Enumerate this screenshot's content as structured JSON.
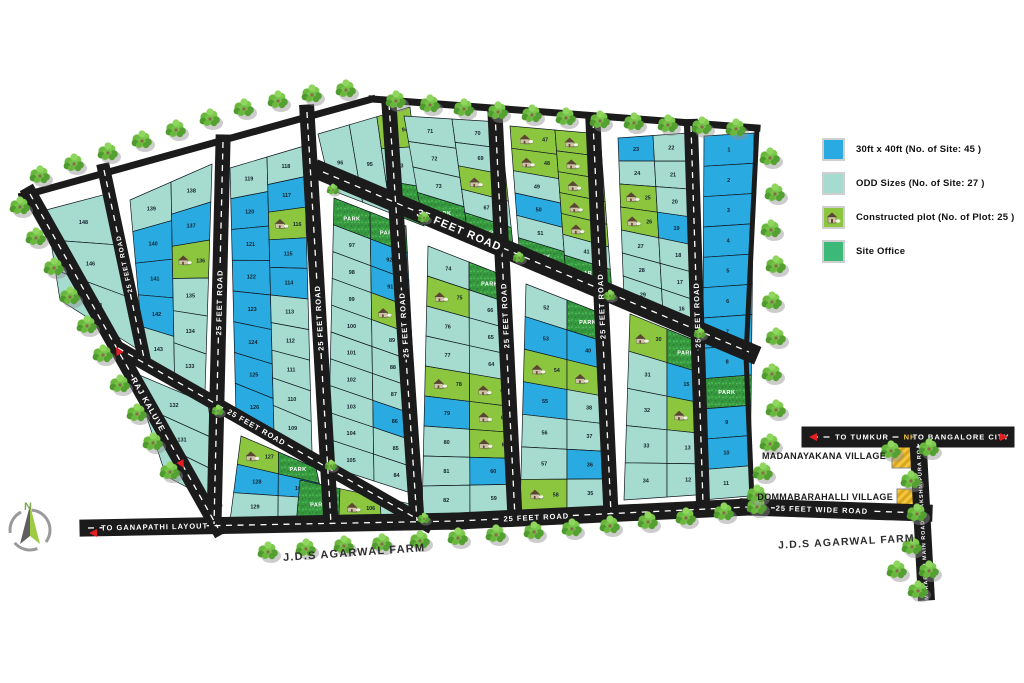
{
  "legend": {
    "items": [
      {
        "key": "blue",
        "label": "30ft x 40ft (No. of Site: 45 )"
      },
      {
        "key": "odd",
        "label": "ODD Sizes (No. of Site: 27 )"
      },
      {
        "key": "constructed",
        "label": "Constructed plot (No. of Plot: 25 )"
      },
      {
        "key": "office",
        "label": "Site Office"
      }
    ]
  },
  "colors": {
    "blue": "#29ABE2",
    "odd": "#A5DCCF",
    "constructed": "#8CC63F",
    "office": "#3CB878",
    "road": "#1b1b1b",
    "park_base": "#37993F",
    "number": "#15222e",
    "arrow_red": "#E31E24",
    "village_yellow": "#F4C73C",
    "nh_yellow": "#F4C73C"
  },
  "roads": {
    "raj_kaluve": "RAJ KALUVE",
    "feet25": "25 FEET ROAD",
    "feet35": "35 FEET ROAD",
    "feet25wide": "25 FEET WIDE ROAD",
    "to_ganapathi": "TO GANAPATHI LAYOUT",
    "to_tumkur": "TO TUMKUR",
    "nh": "NH",
    "to_bangalore": "TO BANGALORE CITY",
    "main_road": "MARABADI MAIN ROAD - LAKSHMIPURA ROAD"
  },
  "places": {
    "village1": "MADANAYAKANA VILLAGE",
    "village2": "DOMMABARAHALLI VILLAGE",
    "farm": "J.D.S AGARWAL FARM",
    "park": "PARK",
    "compass_n": "N"
  },
  "plots": {
    "A": [
      [
        "148:o",
        "146:o",
        "144:o"
      ]
    ],
    "B": [
      [
        "139:o",
        "140:b",
        "141:b",
        "142:b",
        "143:o"
      ],
      [
        "138:o",
        "137:b",
        "136:c",
        "135:o",
        "134:o",
        "133:o"
      ]
    ],
    "BT": [
      [
        "132:o",
        "131:o",
        "130:o"
      ]
    ],
    "CU": [
      [
        "119:o",
        "120:b",
        "121:b",
        "122:b",
        "123:b",
        "124:b",
        "125:b",
        "126:b"
      ],
      [
        "118:o",
        "117:b",
        "116:c",
        "115:b",
        "114:b",
        "113:o",
        "112:o",
        "111:o",
        "110:o",
        "109:o"
      ]
    ],
    "CL": [
      [
        "127:c",
        "128:b",
        "129:o"
      ],
      [
        "PARK:p",
        "108:b",
        "107:o"
      ]
    ],
    "DU": [
      [
        "96:o"
      ],
      [
        "95:o"
      ],
      [
        "94:c",
        "93:o",
        "PARK:p"
      ]
    ],
    "DL": [
      [
        "PARK:p",
        "97:o",
        "98:o",
        "99:o",
        "100:o",
        "101:o",
        "102:o",
        "103:o",
        "104:o",
        "105:o"
      ],
      [
        "PARK:p",
        "92:b",
        "91:b",
        "90:c",
        "89:o",
        "88:o",
        "87:o",
        "86:b",
        "85:o",
        "84:o"
      ]
    ],
    "DB": [
      [
        "PARK:p"
      ],
      [
        "106:c"
      ],
      [
        "83:o"
      ]
    ],
    "EU": [
      [
        "71:o",
        "72:o",
        "73:o",
        "PARK:p"
      ],
      [
        "70:o",
        "69:o",
        "68:c",
        "67:o",
        "PARK:p"
      ]
    ],
    "EL": [
      [
        "74:o",
        "75:c",
        "76:o",
        "77:o",
        "78:c",
        "79:b",
        "80:o",
        "81:o",
        "82:o"
      ],
      [
        "PARK:p",
        "66:o",
        "65:o",
        "64:o",
        "63:c",
        "62:c",
        "61:c",
        "60:b",
        "59:o"
      ]
    ],
    "FU": [
      [
        "47:c",
        "48:c",
        "49:o",
        "50:b",
        "51:o",
        "PARK:p"
      ],
      [
        "46:c",
        "45:c",
        "44:c",
        "43:c",
        "42:c",
        "41:o",
        "PARK:p"
      ]
    ],
    "FL": [
      [
        "52:o",
        "53:b",
        "54:c",
        "55:b",
        "56:o",
        "57:o",
        "58:c"
      ],
      [
        "PARK:p",
        "40:b",
        "39:c",
        "38:o",
        "37:o",
        "36:b",
        "35:o"
      ]
    ],
    "GU": [
      [
        "23:b",
        "24:o",
        "25:c",
        "26:c",
        "27:o",
        "28:o",
        "29:o"
      ],
      [
        "22:o",
        "21:o",
        "20:o",
        "19:b",
        "18:o",
        "17:o",
        "16:o"
      ]
    ],
    "GL": [
      [
        "30:c",
        "31:o",
        "32:o",
        "33:o",
        "34:o"
      ],
      [
        "PARK:p",
        "15:b",
        "14:c",
        "13:o",
        "12:o"
      ]
    ],
    "H": [
      [
        "1:b",
        "2:b",
        "3:b",
        "4:b",
        "5:b",
        "6:b",
        "7:b",
        "8:b",
        "PARK:p",
        "9:b",
        "10:b",
        "11:o"
      ]
    ]
  }
}
